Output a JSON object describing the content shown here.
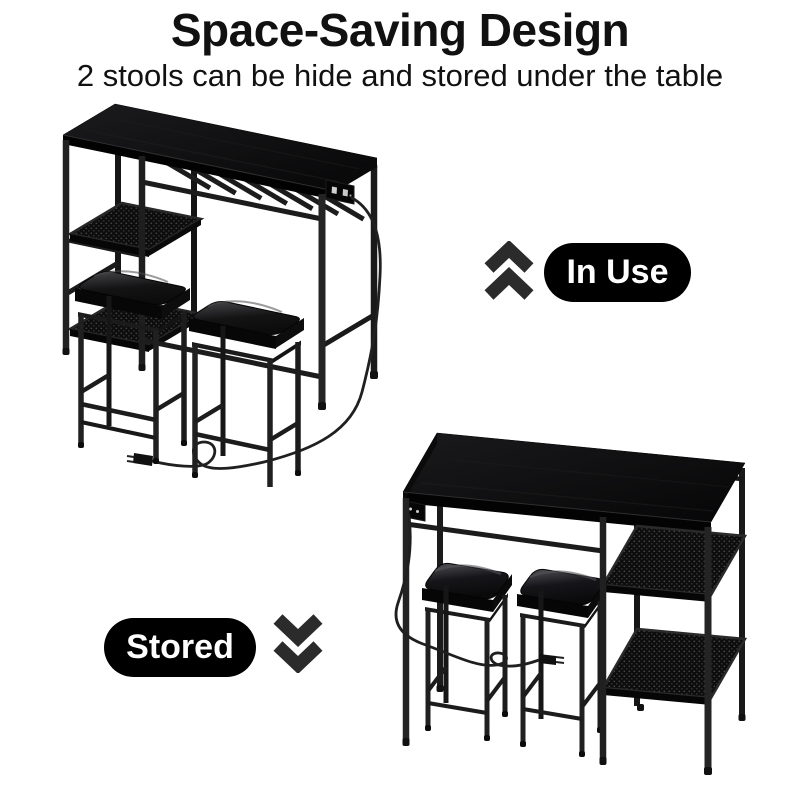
{
  "header": {
    "title": "Space-Saving Design",
    "subtitle": "2 stools can be hide and stored under the table"
  },
  "callouts": {
    "in_use": {
      "label": "In Use",
      "icon": "double-chevron-up-icon"
    },
    "stored": {
      "label": "Stored",
      "icon": "double-chevron-down-icon"
    }
  },
  "figures": {
    "in_use_view": {
      "name": "bar-table-set-with-two-stools-pulled-out"
    },
    "stored_view": {
      "name": "bar-table-set-with-two-stools-stored-under-table"
    }
  },
  "colors": {
    "background": "#ffffff",
    "text": "#111111",
    "badge_background": "#000000",
    "badge_text": "#ffffff",
    "chevron": "#2b2b2b",
    "furniture": "#111111"
  }
}
